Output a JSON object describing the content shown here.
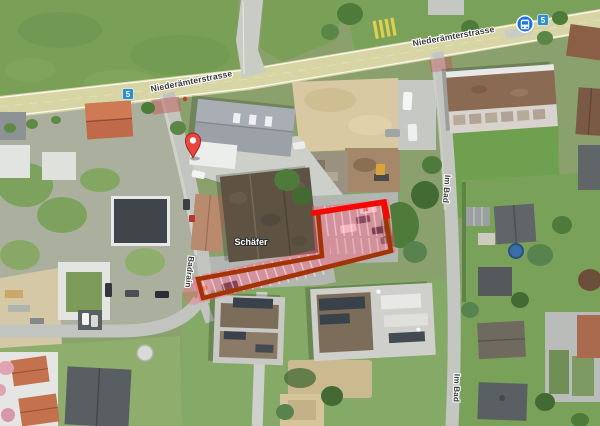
{
  "title": "Satellite map view",
  "labels": {
    "main_street_1": "Niederämterstrasse",
    "main_street_2": "Niederämterstrasse",
    "side_street_left": "Badrain",
    "side_street_right_upper": "Im Bad",
    "side_street_right_lower": "Im Bad",
    "building_label": "Schäfer",
    "route_shield_1": "5",
    "route_shield_2": "5"
  },
  "annotation": {
    "type": "polygon-highlight-parking-area",
    "fill_color": "rgba(255,92,125,0.42)",
    "border_color": "#a23305",
    "highlight_color": "#f60800"
  },
  "colors": {
    "shield_blue": "#2e8fd0",
    "bus_blue": "#1a73e8",
    "pin_red": "#e8453c",
    "road_yellow": "#d8d5a4"
  }
}
